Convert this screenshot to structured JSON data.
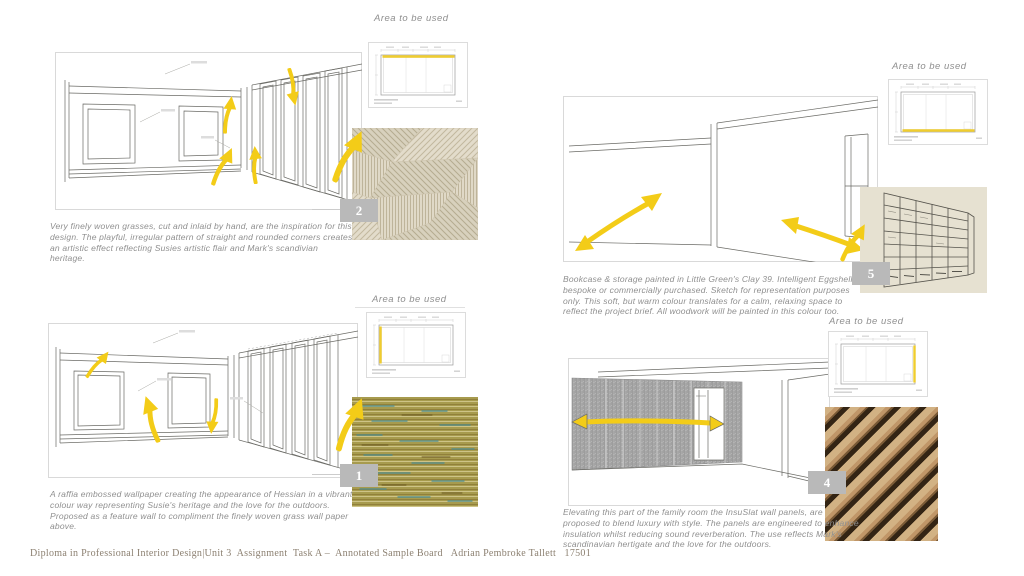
{
  "page": {
    "title": "Annotated Sample Board",
    "footer_text": "Diploma in Professional Interior Design|Unit 3  Assignment  Task A –  Annotated Sample Board   Adrian Pembroke Tallett   17501"
  },
  "labels": {
    "area": "Area to be used"
  },
  "colors": {
    "accent_yellow": "#f3cc18",
    "plan_highlight_yellow": "#f0cd2e",
    "badge_grey": "#b9b9b9",
    "caption_grey": "#8f8f8f",
    "footer_brown": "#8c8071",
    "clay_swatch": "#e6e1d1",
    "raffia_olive": "#a79b4e"
  },
  "quadrants": {
    "q1": {
      "badge": "2",
      "swatch_name": "finely-woven-grass-wallpaper",
      "caption": "Very finely woven grasses, cut and inlaid by hand, are the inspiration for this design. The playful, irregular pattern of straight and rounded corners creates an artistic effect reflecting Susies artistic flair and Mark's scandivian heritage."
    },
    "q2": {
      "badge": "1",
      "swatch_name": "raffia-embossed-wallpaper",
      "caption": "A raffia embossed wallpaper creating the appearance of Hessian in a vibrant colour way representing Susie's heritage and the love for the outdoors. Proposed as a feature wall to compliment the finely woven grass wall paper above."
    },
    "q3": {
      "badge": "5",
      "swatch_name": "clay-39-painted-bookcase",
      "caption": "Bookcase & storage painted in Little Green's Clay 39. Intelligent Eggshell. - bespoke or commercially purchased. Sketch for representation purposes only. This soft, but warm colour translates for a calm, relaxing space to reflect the project brief. All woodwork will be painted in this colour too."
    },
    "q4": {
      "badge": "4",
      "swatch_name": "insuslat-wood-wall-panels",
      "caption": "Elevating this part of the family room the InsuSlat wall panels, are proposed to blend luxury with style. The panels are engineered to enhance insulation whilst reducing sound reverberation. The use reflects Mark's scandinavian hertigate and the love for the outdoors."
    }
  }
}
